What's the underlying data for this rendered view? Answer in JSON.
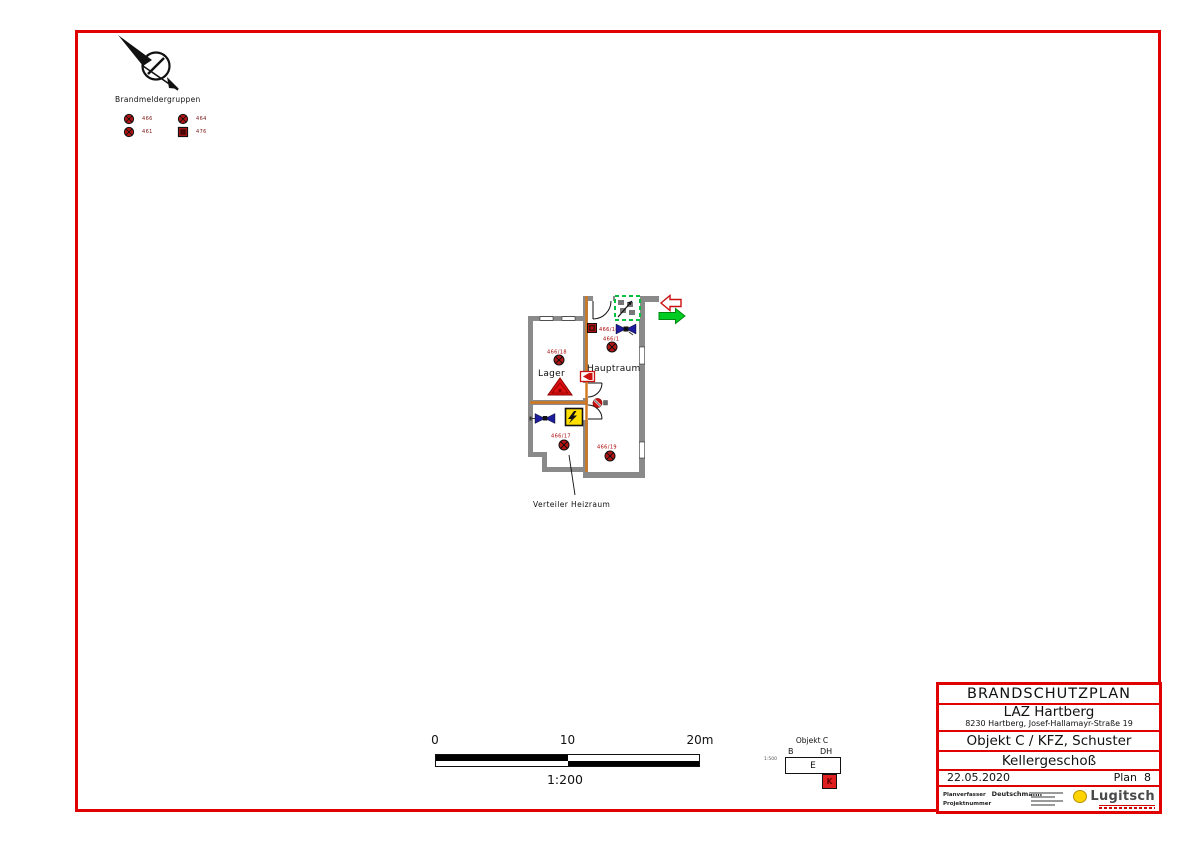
{
  "legend": {
    "title": "Brandmeldergruppen",
    "items": [
      {
        "symbol": "detector-circle",
        "label": "466"
      },
      {
        "symbol": "detector-circle",
        "label": "464"
      },
      {
        "symbol": "detector-circle",
        "label": "461"
      },
      {
        "symbol": "detector-square",
        "label": "476"
      }
    ]
  },
  "plan": {
    "rooms": {
      "lager": "Lager",
      "hauptraum": "Hauptraum"
    },
    "caption": "Verteiler Heizraum",
    "detectors": {
      "mcp_stair": "466/16",
      "hauptraum": "466/1",
      "lager": "466/18",
      "verteiler": "466/17",
      "heizraum": "466/19"
    }
  },
  "scale_bar": {
    "tick_0": "0",
    "tick_10": "10",
    "tick_20": "20m",
    "ratio": "1:200"
  },
  "minimap": {
    "title": "Objekt C",
    "label_b": "B",
    "label_dh": "DH",
    "scale": "1:500",
    "building": "E",
    "marker": "K"
  },
  "title_block": {
    "doc_title": "BRANDSCHUTZPLAN",
    "client": "LAZ Hartberg",
    "client_address": "8230 Hartberg, Josef-Hallamayr-Straße 19",
    "object": "Objekt C / KFZ, Schuster",
    "floor": "Kellergeschoß",
    "date": "22.05.2020",
    "plan_no": "Plan  8",
    "author_label": "Planverfasser",
    "author": "Deutschmann",
    "project_label": "Projektnummer",
    "logo": "Lugitsch"
  },
  "colors": {
    "frame_red": "#e10000",
    "wall_gray": "#8a8a8a",
    "fire_wall_orange": "#d2771e",
    "detector_red": "#b41414",
    "escape_green": "#00cc22",
    "exit_arrow_red": "#cc1111",
    "hazard_yellow": "#ffdf00",
    "siren_blue": "#1c1c9c",
    "stairs_green": "#00c040"
  }
}
